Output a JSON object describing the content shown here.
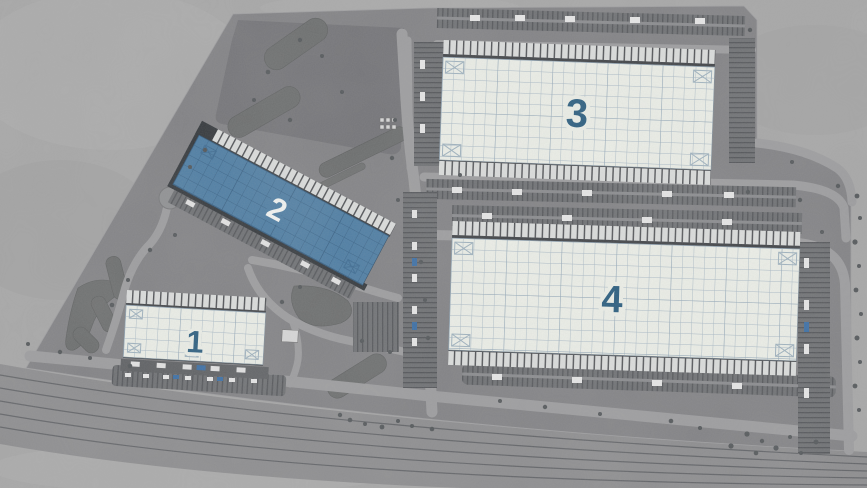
{
  "view": {
    "selected_building_label": "2"
  },
  "buildings": [
    {
      "id": "building-1",
      "label": "1",
      "highlighted": false,
      "fill": "#edf0e9",
      "label_color": "#2a5d7f"
    },
    {
      "id": "building-2",
      "label": "2",
      "highlighted": true,
      "fill": "#4e7ea4",
      "label_color": "#f4f6f4"
    },
    {
      "id": "building-3",
      "label": "3",
      "highlighted": false,
      "fill": "#edf0e9",
      "label_color": "#2a5d7f"
    },
    {
      "id": "building-4",
      "label": "4",
      "highlighted": false,
      "fill": "#edf0e9",
      "label_color": "#2a5d7f"
    }
  ],
  "palette": {
    "ground": "#a7a7a7",
    "pavement": "#828285",
    "pavement_dark": "#747478",
    "road": "#9d9d9f",
    "landscape": "#6b6d6d",
    "railway": "#8d8d8f",
    "rail_line": "#5d5f63",
    "dock_strip": "#dcdedd",
    "grid_light": "#a9b9c6",
    "grid_blue": "#3a658a",
    "highlight_blue": "#4e7ea4"
  }
}
